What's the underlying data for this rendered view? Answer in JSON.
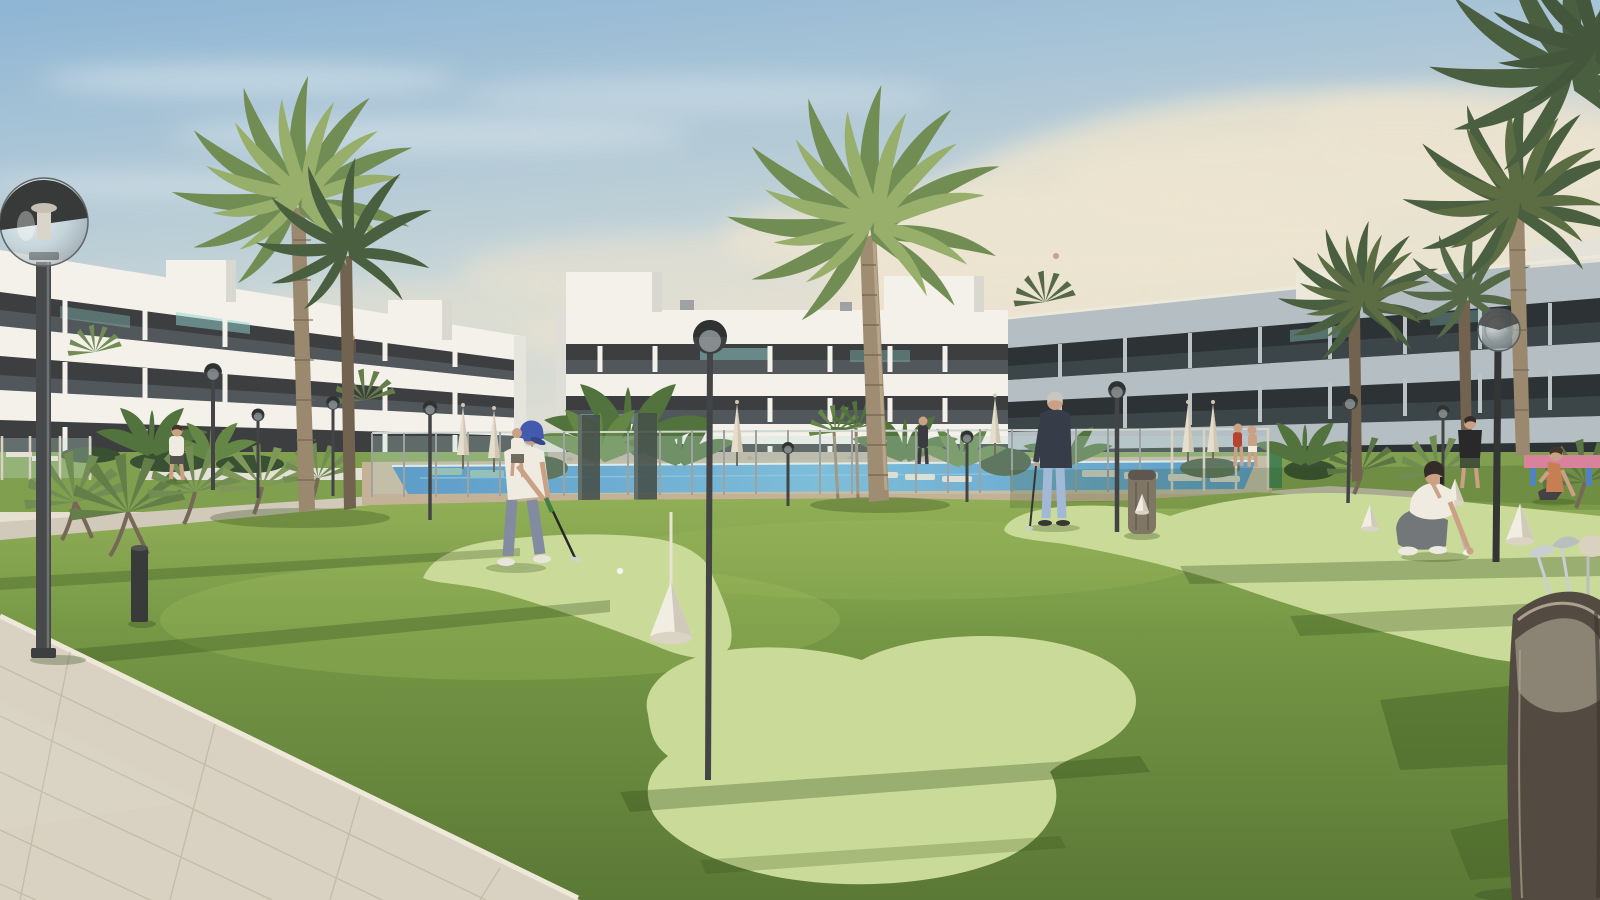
{
  "scene": {
    "type": "3d-architectural-render",
    "setting": "Modern white apartment complex with communal lawn, mini-golf putting greens and swimming pool at golden hour",
    "objects": [
      "sky-with-soft-clouds",
      "left-apartment-building-white-3-storey",
      "middle-apartment-building-white-3-storey",
      "right-apartment-building-in-shadow",
      "swimming-pool-with-glass-fence",
      "sun-loungers",
      "closed-parasols",
      "tall-palm-trees",
      "fan-palm-bushes",
      "banana-plants",
      "globe-lamp-posts",
      "lawn-with-light-putting-greens",
      "white-practice-cones",
      "golf-balls",
      "tiled-walkway-bottom-left",
      "golf-bag-bottom-right",
      "trash-bin",
      "bollard-light",
      "pink-picnic-table",
      "stone-gabion-wall"
    ],
    "people": [
      "golfer-putting-blue-cap",
      "senior-golfer-standing-with-putter",
      "man-crouching-placing-ball-with-phone",
      "woman-sitting-on-lawn",
      "man-standing-black-shirt",
      "woman-walking-near-left-building",
      "woman-walking-near-pool-path",
      "two-swimmers-at-pool-edge",
      "person-at-pool-fence",
      "balcony-figures"
    ]
  },
  "colors": {
    "sky_top": "#8ab4d6",
    "sky_mid": "#c2d3da",
    "sky_horizon": "#eae4d3",
    "cloud_warm": "#ece5d2",
    "cloud_cool": "#dfe9f0",
    "building_white": "#f4f3ee",
    "building_white_shade": "#dddcd6",
    "building_dark": "#33363a",
    "glass_teal": "#8fd4cf",
    "right_band": "#b2bdc4",
    "right_dark": "#232a2e",
    "grass_light": "#8fae54",
    "grass_mid": "#6f9440",
    "grass_deep": "#547430",
    "grass_shadow": "#23400f",
    "putting_green": "#c9db97",
    "pavement": "#d8d2c3",
    "tile_line": "#c0b9a8",
    "path": "#d0cabb",
    "curb": "#efe9db",
    "deck": "#c2b095",
    "stone": "#b7ad9c",
    "pool_blue": "#2e7fc3",
    "pool_light": "#5fb0dd",
    "fence_glass": "#bfe0da",
    "fence_post": "#9aa0a0",
    "fence_post_cream": "#d8d2c2",
    "lamp_dark": "#34373a",
    "globe_glass": "#cfdde2",
    "palm_trunk": "#96856c",
    "palm_trunk_dark": "#6b5d4a",
    "palm_green": "#6b8a4e",
    "palm_green_light": "#93ad68",
    "palm_green_dark": "#42583a",
    "banana_green": "#4a6e37",
    "umbrella": "#e6dfcf",
    "skin": "#c99f83",
    "cap_blue": "#3c55ad",
    "shirt_white": "#f0ede4",
    "pants_blue_grey": "#7d87a0",
    "sweater_dark": "#2e3444",
    "pants_light_blue": "#9db7d8",
    "pants_grey": "#6e7277",
    "yoga_top": "#c77a4e",
    "table_pink": "#d77f9a",
    "table_blue": "#4a7fc1",
    "bag_dark": "#4b443b",
    "bag_light": "#8d8678",
    "club_silver": "#c9ced4",
    "cone_white": "#f2efe6",
    "bin_grey": "#7a7163",
    "hedge_dark": "#31492c"
  }
}
